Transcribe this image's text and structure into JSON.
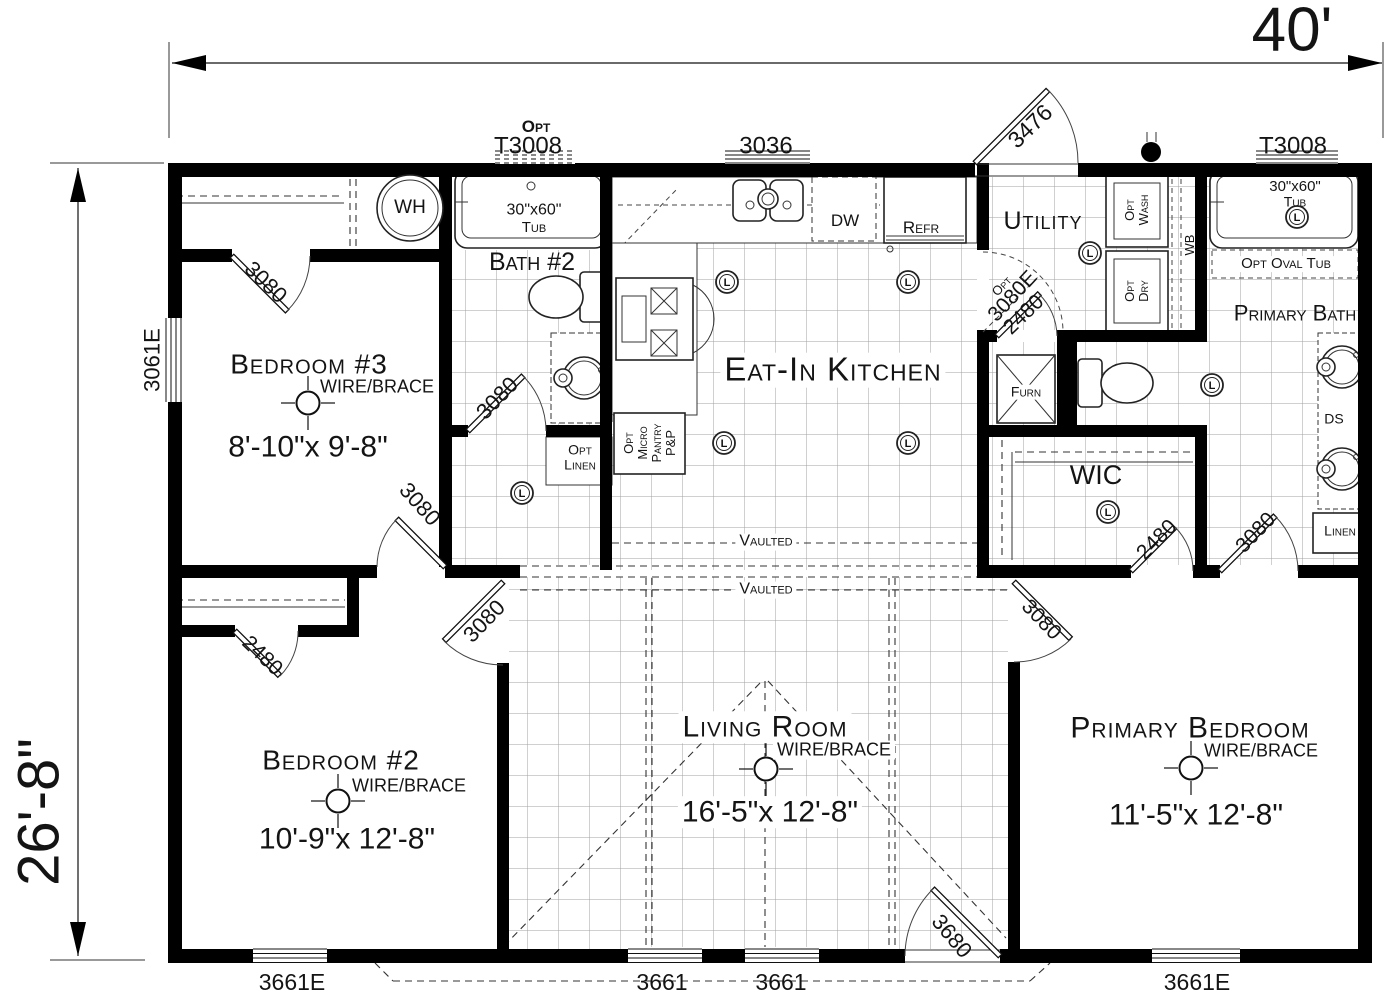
{
  "dimensions": {
    "width": "40'",
    "height": "26'-8\""
  },
  "rooms": {
    "bedroom3": {
      "name": "Bedroom #3",
      "wire_brace": "WIRE/BRACE",
      "size": "8'-10\"x 9'-8\""
    },
    "bath2": {
      "name": "Bath #2"
    },
    "kitchen": {
      "name": "Eat-In Kitchen"
    },
    "utility": {
      "name": "Utility"
    },
    "primary_bath": {
      "name": "Primary Bath"
    },
    "wic": {
      "name": "WIC"
    },
    "bedroom2": {
      "name": "Bedroom #2",
      "wire_brace": "WIRE/BRACE",
      "size": "10'-9\"x 12'-8\""
    },
    "living_room": {
      "name": "Living Room",
      "wire_brace": "WIRE/BRACE",
      "size": "16'-5\"x 12'-8\""
    },
    "primary_bedroom": {
      "name": "Primary Bedroom",
      "wire_brace": "WIRE/BRACE",
      "size": "11'-5\"x 12'-8\""
    }
  },
  "windows": {
    "bath2_top_opt": "Opt",
    "bath2_top": "T3008",
    "kitchen_top": "3036",
    "primary_bath_top": "T3008",
    "bedroom3_left": "3061E",
    "bedroom2_bottom": "3661E",
    "living_bottom_left": "3661",
    "living_bottom_right": "3661",
    "primary_bedroom_bottom": "3661E"
  },
  "doors": {
    "utility_exterior": "3476",
    "entry_exterior": "3680",
    "bedroom3_closet": "3080",
    "bedroom3": "3080",
    "bath2": "3080",
    "kitchen_utility_opt_prefix": "Opt",
    "kitchen_utility_opt": "3080E",
    "furnace": "2480",
    "wic": "2480",
    "primary_bath": "3080",
    "primary_bedroom": "3080",
    "bedroom2_closet": "2480",
    "bedroom2": "3080"
  },
  "fixtures": {
    "water_heater": "WH",
    "tub_size": "30\"x60\"",
    "tub_word": "Tub",
    "dishwasher": "DW",
    "refrigerator": "Refr",
    "washer": [
      "Opt",
      "Wash"
    ],
    "dryer": [
      "Opt",
      "Dry"
    ],
    "workbench": "WB",
    "furnace": "Furn",
    "opt_oval_tub": "Opt Oval Tub",
    "double_sink": "DS",
    "linen": "Linen",
    "opt_linen": [
      "Opt",
      "Linen"
    ],
    "pantry": [
      "Opt",
      "Micro",
      "Pantry",
      "P&P"
    ],
    "light": "L"
  },
  "ceiling": {
    "vaulted": "Vaulted"
  }
}
